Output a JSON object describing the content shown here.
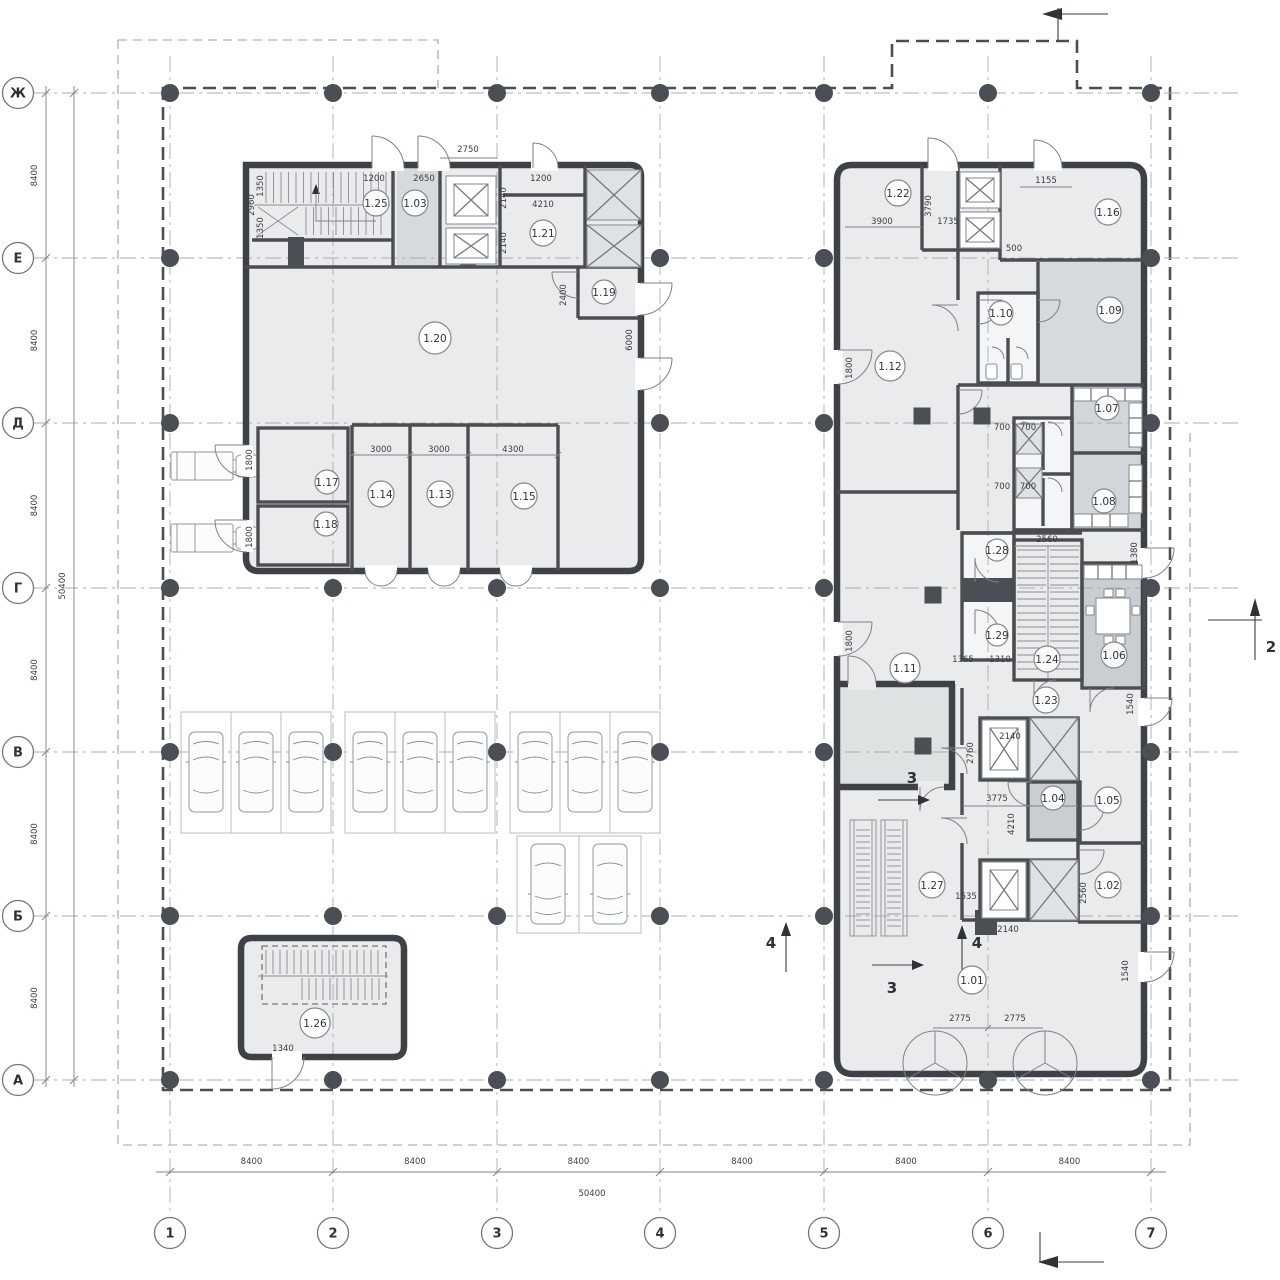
{
  "axes": {
    "rows": [
      "Ж",
      "Е",
      "Д",
      "Г",
      "В",
      "Б",
      "А"
    ],
    "cols": [
      "1",
      "2",
      "3",
      "4",
      "5",
      "6",
      "7"
    ]
  },
  "dimensions": {
    "left": [
      "8400",
      "8400",
      "8400",
      "8400",
      "8400",
      "8400"
    ],
    "left_total": "50400",
    "bottom": [
      "8400",
      "8400",
      "8400",
      "8400",
      "8400",
      "8400"
    ],
    "bottom_total": "50400"
  },
  "rooms": [
    {
      "label": "1.25",
      "x": 376,
      "y": 203,
      "r": 13
    },
    {
      "label": "1.03",
      "x": 415,
      "y": 203,
      "r": 13
    },
    {
      "label": "1.21",
      "x": 543,
      "y": 233,
      "r": 13
    },
    {
      "label": "1.19",
      "x": 604,
      "y": 292,
      "r": 12
    },
    {
      "label": "1.20",
      "x": 435,
      "y": 338,
      "r": 16
    },
    {
      "label": "1.17",
      "x": 327,
      "y": 482,
      "r": 12
    },
    {
      "label": "1.18",
      "x": 326,
      "y": 524,
      "r": 12
    },
    {
      "label": "1.14",
      "x": 381,
      "y": 494,
      "r": 13
    },
    {
      "label": "1.13",
      "x": 440,
      "y": 494,
      "r": 13
    },
    {
      "label": "1.15",
      "x": 524,
      "y": 496,
      "r": 13
    },
    {
      "label": "1.26",
      "x": 315,
      "y": 1023,
      "r": 15
    },
    {
      "label": "1.22",
      "x": 898,
      "y": 193,
      "r": 13
    },
    {
      "label": "1.16",
      "x": 1108,
      "y": 212,
      "r": 13
    },
    {
      "label": "1.10",
      "x": 1001,
      "y": 313,
      "r": 12
    },
    {
      "label": "1.09",
      "x": 1110,
      "y": 310,
      "r": 13
    },
    {
      "label": "1.12",
      "x": 890,
      "y": 366,
      "r": 15
    },
    {
      "label": "1.07",
      "x": 1107,
      "y": 408,
      "r": 12
    },
    {
      "label": "1.08",
      "x": 1104,
      "y": 501,
      "r": 12
    },
    {
      "label": "1.28",
      "x": 997,
      "y": 550,
      "r": 11
    },
    {
      "label": "1.29",
      "x": 997,
      "y": 635,
      "r": 11
    },
    {
      "label": "1.24",
      "x": 1047,
      "y": 659,
      "r": 13
    },
    {
      "label": "1.06",
      "x": 1114,
      "y": 655,
      "r": 13
    },
    {
      "label": "1.23",
      "x": 1046,
      "y": 700,
      "r": 13
    },
    {
      "label": "1.11",
      "x": 905,
      "y": 668,
      "r": 15
    },
    {
      "label": "1.04",
      "x": 1053,
      "y": 798,
      "r": 12
    },
    {
      "label": "1.05",
      "x": 1108,
      "y": 800,
      "r": 13
    },
    {
      "label": "1.27",
      "x": 932,
      "y": 885,
      "r": 13
    },
    {
      "label": "1.02",
      "x": 1108,
      "y": 885,
      "r": 13
    },
    {
      "label": "1.01",
      "x": 972,
      "y": 980,
      "r": 14
    }
  ],
  "annotations": [
    {
      "t": "2750",
      "x": 468,
      "y": 152
    },
    {
      "t": "1200",
      "x": 374,
      "y": 181
    },
    {
      "t": "2650",
      "x": 424,
      "y": 181
    },
    {
      "t": "1200",
      "x": 541,
      "y": 181
    },
    {
      "t": "4210",
      "x": 543,
      "y": 207
    },
    {
      "t": "2140",
      "x": 506,
      "y": 198,
      "r": -90
    },
    {
      "t": "2140",
      "x": 506,
      "y": 243,
      "r": -90
    },
    {
      "t": "2960",
      "x": 254,
      "y": 205,
      "r": -90
    },
    {
      "t": "1350",
      "x": 263,
      "y": 186,
      "r": -90
    },
    {
      "t": "1350",
      "x": 263,
      "y": 228,
      "r": -90
    },
    {
      "t": "2400",
      "x": 566,
      "y": 295,
      "r": -90
    },
    {
      "t": "6000",
      "x": 632,
      "y": 340,
      "r": -90
    },
    {
      "t": "3000",
      "x": 381,
      "y": 452
    },
    {
      "t": "3000",
      "x": 439,
      "y": 452
    },
    {
      "t": "4300",
      "x": 513,
      "y": 452
    },
    {
      "t": "1800",
      "x": 252,
      "y": 460,
      "r": -90
    },
    {
      "t": "1800",
      "x": 252,
      "y": 537,
      "r": -90
    },
    {
      "t": "1340",
      "x": 283,
      "y": 1051
    },
    {
      "t": "3900",
      "x": 882,
      "y": 224
    },
    {
      "t": "3790",
      "x": 931,
      "y": 206,
      "r": -90
    },
    {
      "t": "1735",
      "x": 948,
      "y": 224
    },
    {
      "t": "1155",
      "x": 1046,
      "y": 183
    },
    {
      "t": "500",
      "x": 1014,
      "y": 251
    },
    {
      "t": "1800",
      "x": 852,
      "y": 368,
      "r": -90
    },
    {
      "t": "1800",
      "x": 852,
      "y": 641,
      "r": -90
    },
    {
      "t": "700",
      "x": 1002,
      "y": 430
    },
    {
      "t": "700",
      "x": 1028,
      "y": 430
    },
    {
      "t": "700",
      "x": 1002,
      "y": 489
    },
    {
      "t": "700",
      "x": 1028,
      "y": 489
    },
    {
      "t": "2560",
      "x": 1047,
      "y": 542
    },
    {
      "t": "1380",
      "x": 1137,
      "y": 553,
      "r": -90
    },
    {
      "t": "1365",
      "x": 963,
      "y": 662
    },
    {
      "t": "1310",
      "x": 1000,
      "y": 662
    },
    {
      "t": "1540",
      "x": 1133,
      "y": 704,
      "r": -90
    },
    {
      "t": "2140",
      "x": 1010,
      "y": 739
    },
    {
      "t": "2760",
      "x": 973,
      "y": 753,
      "r": -90
    },
    {
      "t": "3775",
      "x": 997,
      "y": 801
    },
    {
      "t": "4210",
      "x": 1014,
      "y": 824,
      "r": -90
    },
    {
      "t": "1535",
      "x": 966,
      "y": 899
    },
    {
      "t": "2560",
      "x": 1086,
      "y": 893,
      "r": -90
    },
    {
      "t": "2140",
      "x": 1008,
      "y": 932
    },
    {
      "t": "2775",
      "x": 960,
      "y": 1021
    },
    {
      "t": "2775",
      "x": 1015,
      "y": 1021
    },
    {
      "t": "1540",
      "x": 1128,
      "y": 971,
      "r": -90
    }
  ],
  "sections": [
    {
      "t": "2",
      "x": 1271,
      "y": 652
    },
    {
      "t": "3",
      "x": 912,
      "y": 783
    },
    {
      "t": "3",
      "x": 892,
      "y": 993
    },
    {
      "t": "4",
      "x": 771,
      "y": 948
    },
    {
      "t": "4",
      "x": 977,
      "y": 948
    }
  ],
  "plan": {
    "columns": [
      {
        "x": 170,
        "y": 93
      },
      {
        "x": 333,
        "y": 93
      },
      {
        "x": 497,
        "y": 93
      },
      {
        "x": 660,
        "y": 93
      },
      {
        "x": 824,
        "y": 93
      },
      {
        "x": 988,
        "y": 93
      },
      {
        "x": 1151,
        "y": 93
      },
      {
        "x": 170,
        "y": 258
      },
      {
        "x": 660,
        "y": 258
      },
      {
        "x": 824,
        "y": 258
      },
      {
        "x": 1151,
        "y": 258
      },
      {
        "x": 170,
        "y": 423
      },
      {
        "x": 660,
        "y": 423
      },
      {
        "x": 824,
        "y": 423
      },
      {
        "x": 1151,
        "y": 423
      },
      {
        "x": 170,
        "y": 588
      },
      {
        "x": 333,
        "y": 588
      },
      {
        "x": 497,
        "y": 588
      },
      {
        "x": 660,
        "y": 588
      },
      {
        "x": 824,
        "y": 588
      },
      {
        "x": 1151,
        "y": 588
      },
      {
        "x": 170,
        "y": 752
      },
      {
        "x": 333,
        "y": 752
      },
      {
        "x": 497,
        "y": 752
      },
      {
        "x": 660,
        "y": 752
      },
      {
        "x": 824,
        "y": 752
      },
      {
        "x": 1151,
        "y": 752
      },
      {
        "x": 170,
        "y": 916
      },
      {
        "x": 333,
        "y": 916
      },
      {
        "x": 497,
        "y": 916
      },
      {
        "x": 660,
        "y": 916
      },
      {
        "x": 824,
        "y": 916
      },
      {
        "x": 1151,
        "y": 916
      },
      {
        "x": 170,
        "y": 1080
      },
      {
        "x": 333,
        "y": 1080
      },
      {
        "x": 497,
        "y": 1080
      },
      {
        "x": 660,
        "y": 1080
      },
      {
        "x": 824,
        "y": 1080
      },
      {
        "x": 988,
        "y": 1080
      },
      {
        "x": 1151,
        "y": 1080
      },
      {
        "x": 922,
        "y": 416,
        "s": "sq"
      },
      {
        "x": 982,
        "y": 416,
        "s": "sq"
      },
      {
        "x": 933,
        "y": 595,
        "s": "sq"
      },
      {
        "x": 923,
        "y": 746,
        "s": "sq"
      }
    ],
    "colors": {
      "wall": "#3e4145",
      "room_light": "#e9ebed",
      "room_mid": "#d7dadd",
      "room_dark": "#c9ced2"
    }
  }
}
